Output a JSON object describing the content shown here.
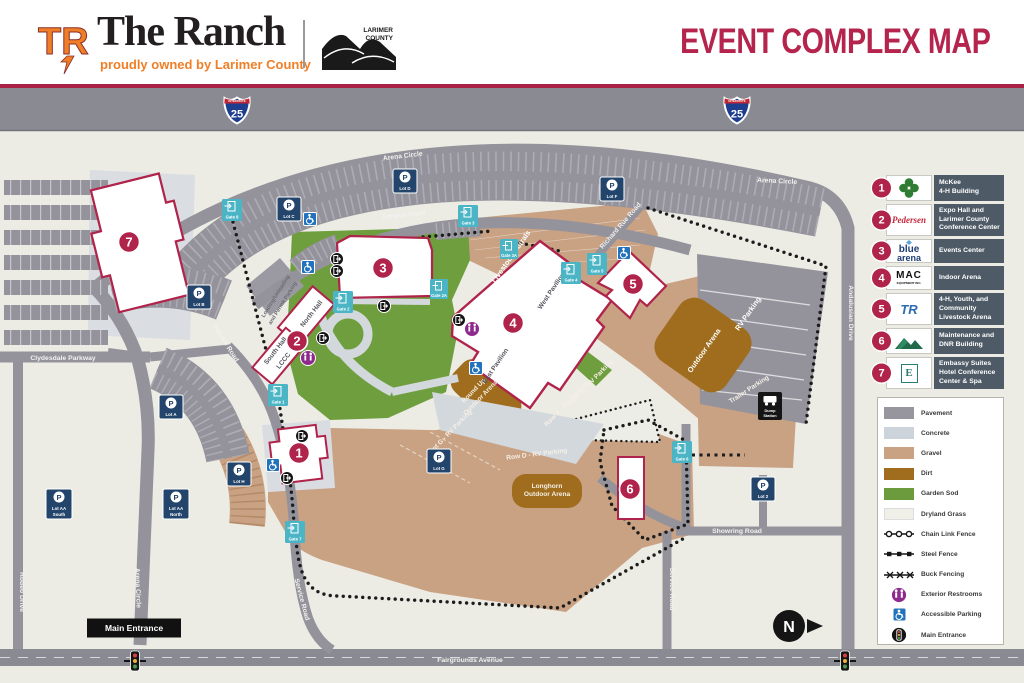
{
  "header": {
    "brand_tr": "TR",
    "title": "The Ranch",
    "tagline": "proudly owned by Larimer County",
    "county": {
      "line1": "LARIMER",
      "line2": "COUNTY"
    },
    "page_title": "EVENT COMPLEX MAP"
  },
  "colors": {
    "brand_crimson": "#B0234A",
    "brand_orange": "#F07E26",
    "legend_slate": "#4E5A66",
    "lot_navy": "#24456B",
    "gate_teal": "#4BB5C6",
    "restroom_purple": "#8E2A8D",
    "accessible_blue": "#2273BB",
    "pavement": "#97969F",
    "concrete": "#CDD3DA",
    "gravel": "#C9A183",
    "dirt": "#9F6D1D",
    "garden_sod": "#6B9B3D",
    "dryland": "#F0F0E8"
  },
  "legend_buildings": [
    {
      "n": "1",
      "label": "McKee\n4-H Building"
    },
    {
      "n": "2",
      "label": "Expo Hall and\nLarimer County\nConference Center",
      "logo_text": "Pedersen"
    },
    {
      "n": "3",
      "label": "Events Center",
      "logo_line1": "blue",
      "logo_line2": "arena"
    },
    {
      "n": "4",
      "label": "Indoor Arena",
      "logo_text": "MAC",
      "logo_sub": "EQUIPMENT INC."
    },
    {
      "n": "5",
      "label": "4-H, Youth, and\nCommunity\nLivestock Arena",
      "logo_text": "TR"
    },
    {
      "n": "6",
      "label": "Maintenance and\nDNR Building"
    },
    {
      "n": "7",
      "label": "Embassy Suites\nHotel Conference\nCenter & Spa",
      "logo_text": "E"
    }
  ],
  "legend_surfaces": [
    {
      "label": "Pavement"
    },
    {
      "label": "Concrete"
    },
    {
      "label": "Gravel"
    },
    {
      "label": "Dirt"
    },
    {
      "label": "Garden Sod"
    },
    {
      "label": "Dryland Grass"
    },
    {
      "label": "Chain Link Fence"
    },
    {
      "label": "Steel Fence"
    },
    {
      "label": "Buck Fencing"
    },
    {
      "label": "Exterior Restrooms"
    },
    {
      "label": "Accessible Parking"
    },
    {
      "label": "Main Entrance"
    }
  ],
  "map": {
    "interstate_label": "INTERSTATE",
    "interstate_num": "25",
    "p": "P",
    "north": "N",
    "main_entrance": "Main Entrance",
    "dump1": "Dump",
    "dump2": "Station",
    "road_labels": [
      {
        "text": "Arena Circle"
      },
      {
        "text": "Service Road"
      },
      {
        "text": "Arena Circle"
      },
      {
        "text": "Clydesdale Parkway"
      },
      {
        "text": "Rodeo Drive"
      },
      {
        "text": "Arena Circle"
      },
      {
        "text": "Service Road"
      },
      {
        "text": "Service Road"
      },
      {
        "text": "Service Road"
      },
      {
        "text": "Andalusian Drive"
      },
      {
        "text": "Showring Road"
      },
      {
        "text": "Fairgrounds Avenue"
      },
      {
        "text": "Richard Rue Road"
      }
    ],
    "area_labels": [
      {
        "text": "Livestock Corrals"
      },
      {
        "text": "Outdoor Arena"
      },
      {
        "text": "RV Parking"
      },
      {
        "text": "Round Up"
      },
      {
        "text": "Outdoor Arena"
      },
      {
        "text": "Longhorn"
      },
      {
        "text": "Outdoor Arena"
      },
      {
        "text": "Row D - RV Parking"
      },
      {
        "text": "Row A - RV Parking"
      },
      {
        "text": "Lot G - RV Parking"
      },
      {
        "text": "Row B - RV Parking"
      },
      {
        "text": "Trailer Parking"
      }
    ],
    "dark_labels": [
      {
        "text": "West Pavilion"
      },
      {
        "text": "East Pavilion"
      },
      {
        "text": "North Hall"
      },
      {
        "text": "South Hall"
      },
      {
        "text": "LCCC"
      },
      {
        "text": "Loading/Unloading"
      },
      {
        "text": "and Permit Parking"
      }
    ],
    "lots": [
      {
        "label": "Lot D"
      },
      {
        "label": "Lot C"
      },
      {
        "label": "Lot F"
      },
      {
        "label": "Lot B"
      },
      {
        "label": "Lot A"
      },
      {
        "label": "Lot H"
      },
      {
        "label": "Lot G"
      },
      {
        "label": "Lot 2"
      },
      {
        "label": "Lot AA",
        "label2": "South"
      },
      {
        "label": "Lot AA",
        "label2": "North"
      }
    ],
    "gates": [
      {
        "label": "Gate 8"
      },
      {
        "label": "Gate 3"
      },
      {
        "label": "Gate 3A"
      },
      {
        "label": "Gate 2"
      },
      {
        "label": "Gate 2A"
      },
      {
        "label": "Gate 4"
      },
      {
        "label": "Gate 5"
      },
      {
        "label": "Gate 1"
      },
      {
        "label": "Gate 6"
      },
      {
        "label": "Gate 7"
      }
    ],
    "badges": [
      {
        "n": "7"
      },
      {
        "n": "3"
      },
      {
        "n": "2"
      },
      {
        "n": "4"
      },
      {
        "n": "5"
      },
      {
        "n": "1"
      },
      {
        "n": "6"
      }
    ]
  }
}
